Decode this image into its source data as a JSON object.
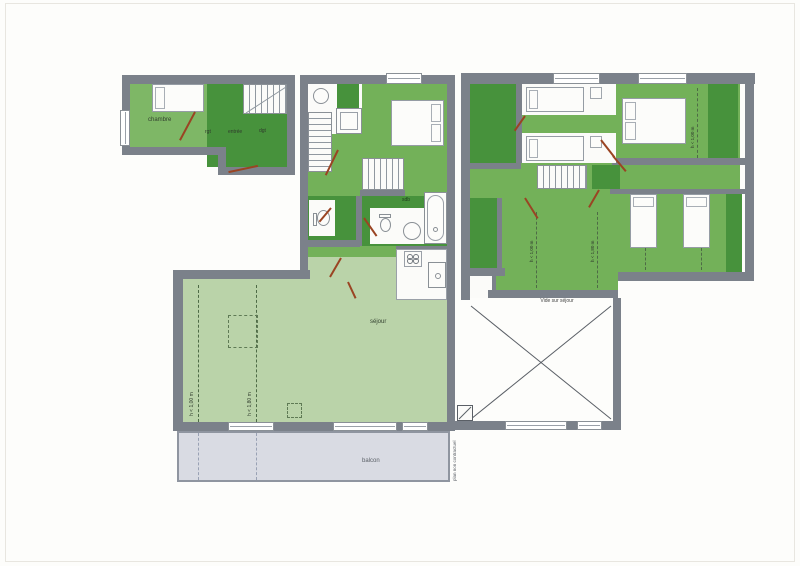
{
  "document": {
    "kind": "apartment duplex floor plan, scanned drawing",
    "disclaimer": "plan non contractuel"
  },
  "colors": {
    "wall": "#7b818a",
    "room_green_mid": "#73b159",
    "room_green_dark": "#47923c",
    "room_green_light": "#bad3a9",
    "balcony": "#d9dbe3",
    "door_swing": "#9a4423"
  },
  "rooms": {
    "chambre": "chambre",
    "rangement": "rgt",
    "entree": "entrée",
    "degagement": "dgt",
    "ch1": "ch. 1",
    "sdb": "sdb",
    "sejour": "séjour",
    "balcon": "balcon",
    "vide_sur_sejour": "Vide sur séjour"
  },
  "annotations": {
    "h_max_100": "h < 1,00 m",
    "h_max_180": "h < 1,80 m",
    "disclaimer": "plan non contractuel"
  }
}
